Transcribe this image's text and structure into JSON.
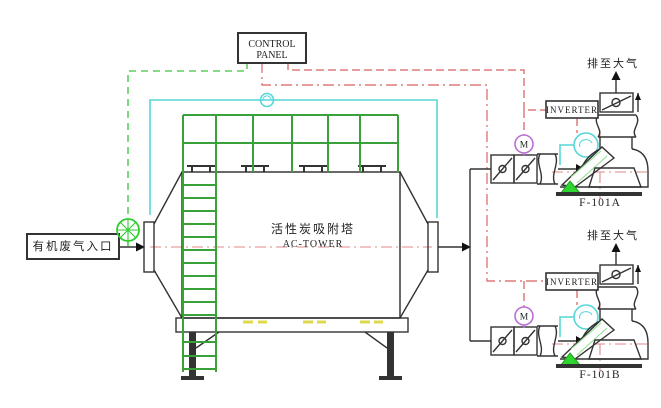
{
  "diagram_title": "AC-TOWER activated carbon adsorption system P&ID",
  "control_panel": {
    "line1": "CONTROL",
    "line2": "PANEL"
  },
  "inlet": {
    "label": "有机废气入口"
  },
  "tower": {
    "name_cn": "活性炭吸附塔",
    "name_en": "AC-TOWER"
  },
  "fan_units": [
    {
      "id": "A",
      "exhaust_label": "排至大气",
      "inverter_label": "INVERTER",
      "fan_tag": "F-101A",
      "motor_label": "M"
    },
    {
      "id": "B",
      "exhaust_label": "排至大气",
      "inverter_label": "INVERTER",
      "fan_tag": "F-101B",
      "motor_label": "M"
    }
  ],
  "colors": {
    "line": "#333333",
    "structure_green": "#3aa03a",
    "signal_green": "#5ecf5e",
    "signal_red": "#e07a7a",
    "signal_cyan": "#57d6d6",
    "motor_magenta": "#bb6fd6",
    "device_green": "#2ecc2e",
    "bright_green_fill": "#2ed52e",
    "yellow_marks": "#ddd84e",
    "background": "#ffffff"
  }
}
